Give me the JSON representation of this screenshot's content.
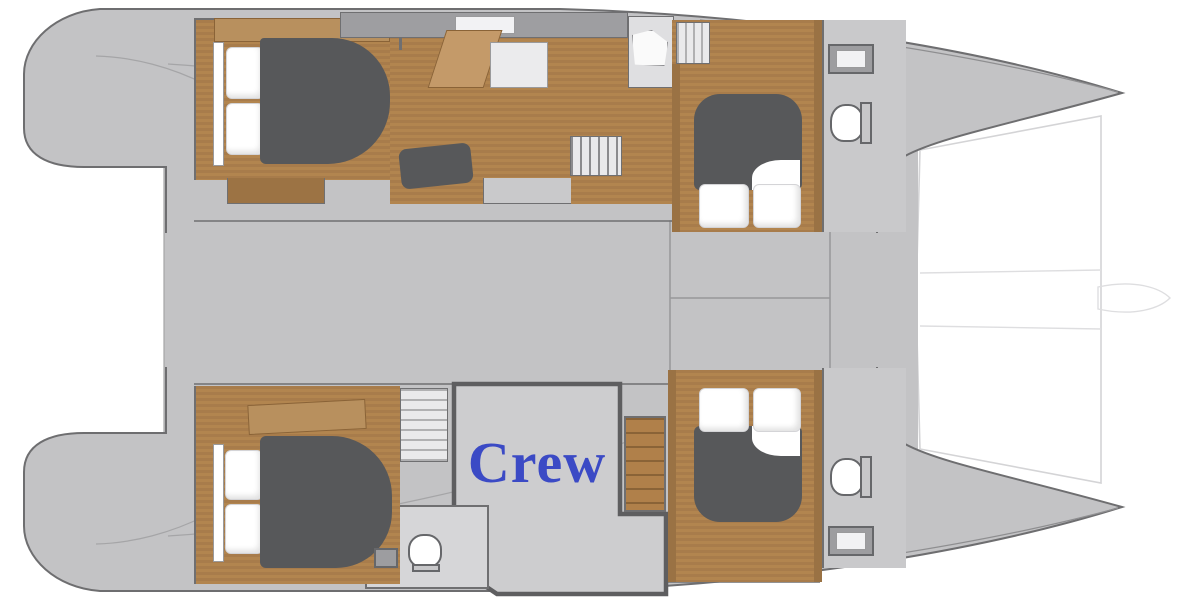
{
  "diagram": {
    "type": "catamaran-yacht-deck-plan",
    "orientation": "bow-right",
    "annotation": {
      "crew": "Crew"
    },
    "hulls": {
      "port": [
        "aft-double-cabin",
        "salon-galley",
        "shower-room",
        "stairs",
        "forward-double-cabin",
        "forward-head"
      ],
      "starboard": [
        "aft-double-cabin",
        "companionway-stairs",
        "crew-quarters",
        "crew-head",
        "stairs",
        "forward-double-cabin",
        "forward-head"
      ]
    },
    "colors": {
      "background": "#ffffff",
      "deck": "#c3c3c5",
      "hull_outline": "#6e6e70",
      "wood_floor": "#a87c4b",
      "wood_trim": "#c49a69",
      "mattress": "#57585a",
      "pillow": "#ffffff",
      "crew_fill": "#cdcdcf",
      "crew_border": "#5e5e60",
      "crew_text": "#3b4ac5",
      "trampoline_line": "#d4d4d6"
    }
  }
}
